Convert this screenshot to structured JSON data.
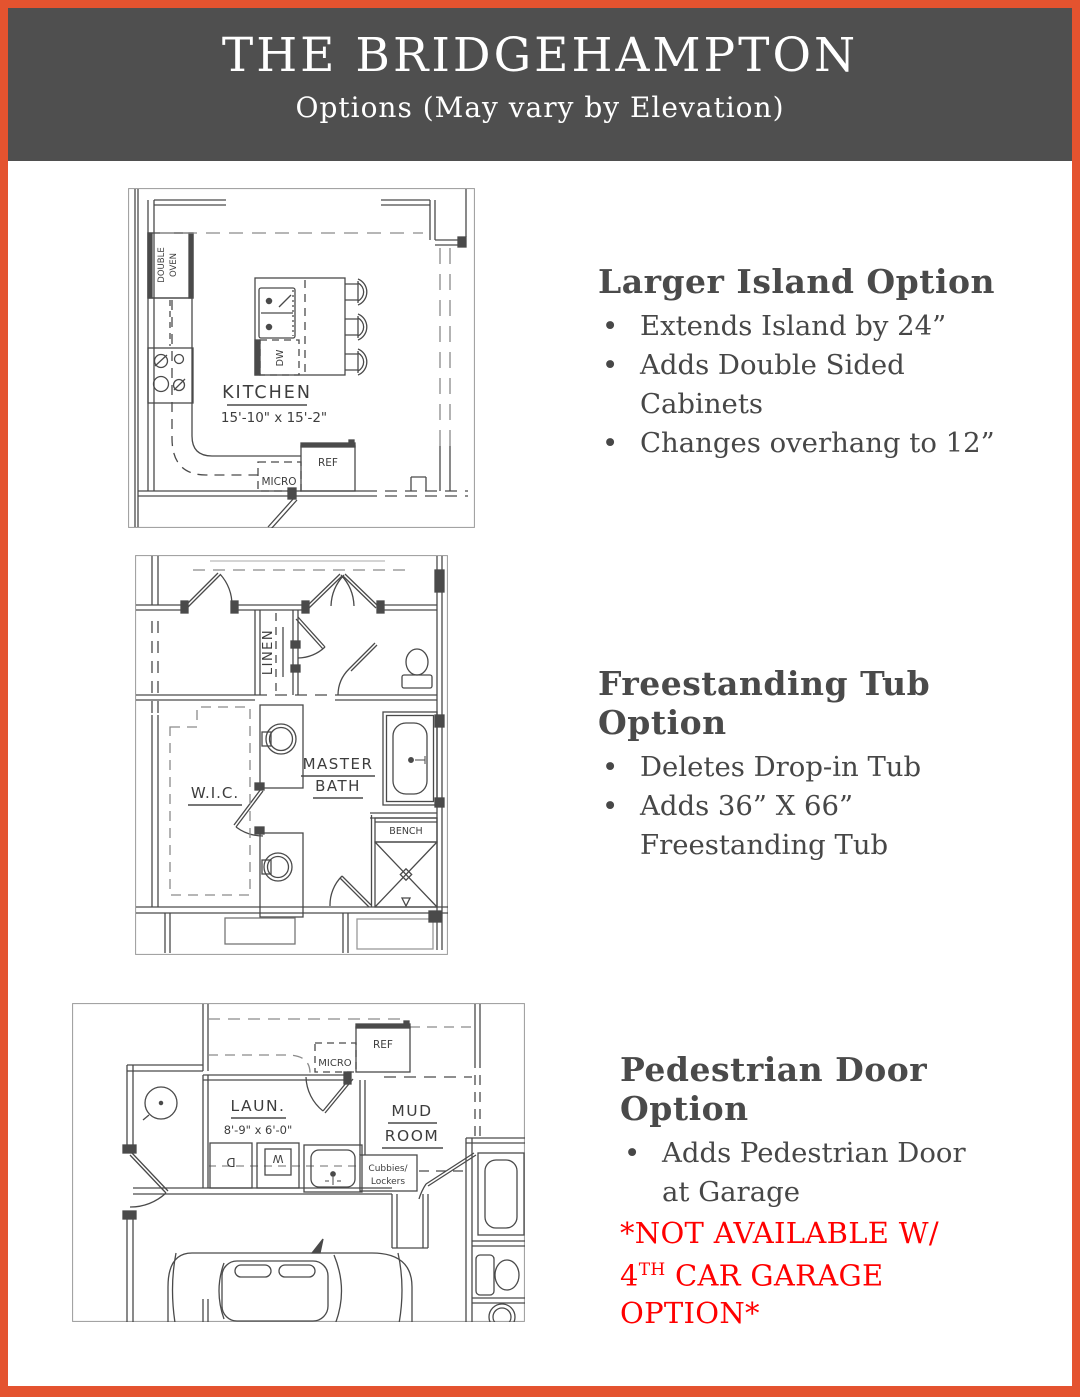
{
  "page": {
    "title": "THE BRIDGEHAMPTON",
    "subtitle": "Options (May vary by Elevation)",
    "colors": {
      "border": "#E4532F",
      "header_bg": "#4F4F4F",
      "text": "#474747",
      "note": "#FF0000"
    }
  },
  "sections": [
    {
      "heading": "Larger Island Option",
      "bullets": [
        "Extends Island by 24”",
        "Adds Double Sided Cabinets",
        "Changes overhang to 12”"
      ]
    },
    {
      "heading": "Freestanding Tub Option",
      "bullets": [
        "Deletes Drop-in Tub",
        "Adds 36” X 66” Freestanding Tub"
      ]
    },
    {
      "heading": "Pedestrian Door Option",
      "bullets": [
        "Adds Pedestrian Door at Garage"
      ],
      "note": {
        "pre": "*NOT AVAILABLE W/ 4",
        "sup": "TH",
        "post": " CAR GARAGE OPTION*"
      }
    }
  ],
  "plans": {
    "kitchen": {
      "room": "KITCHEN",
      "dims": "15'-10\" x 15'-2\"",
      "oven1": "DOUBLE",
      "oven2": "OVEN",
      "dw": "DW",
      "ref": "REF",
      "micro": "MICRO"
    },
    "master_bath": {
      "linen": "LINEN",
      "master": "MASTER",
      "bath": "BATH",
      "wic": "W.I.C.",
      "bench": "BENCH"
    },
    "mud_room": {
      "ref": "REF",
      "micro": "MICRO",
      "laun": "LAUN.",
      "dims": "8'-9\" x 6'-0\"",
      "mud": "MUD",
      "room": "ROOM",
      "cubbies1": "Cubbies/",
      "cubbies2": "Lockers",
      "washer": "W",
      "dryer": "D"
    }
  }
}
